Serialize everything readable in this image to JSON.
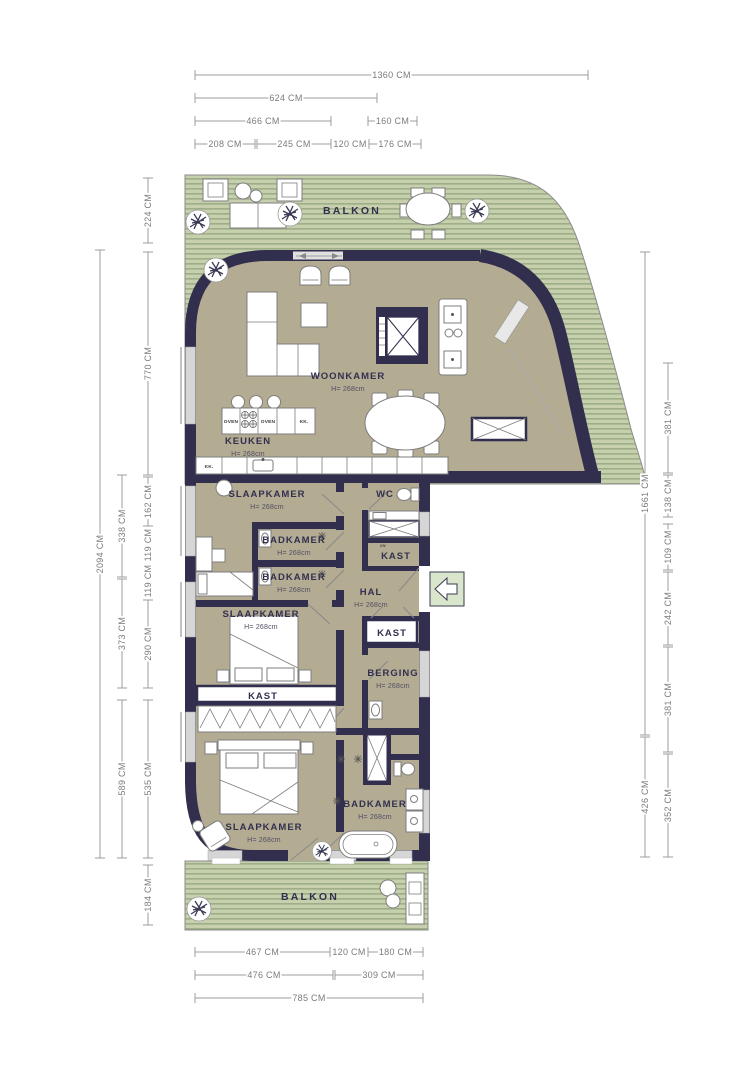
{
  "plan": {
    "title": "Apartment floor plan",
    "colors": {
      "wall": "#312e4e",
      "floor": "#b4ab93",
      "deck_base": "#c6d0ad",
      "deck_stripe": "#9aab85",
      "dimension_line": "#9c9c9c",
      "dimension_text": "#7b7b7b",
      "label_text": "#32304f",
      "entry_arrow_bg": "#d9e6cc"
    },
    "entry": {
      "icon": "arrow-left",
      "meaning": "entrance"
    },
    "rooms": [
      {
        "id": "balkon-top",
        "label": "BALKON",
        "x": 352,
        "y": 214
      },
      {
        "id": "woonkamer",
        "label": "WOONKAMER",
        "sub": "H= 268cm",
        "x": 348,
        "y": 379
      },
      {
        "id": "keuken",
        "label": "KEUKEN",
        "sub": "H= 268cm",
        "x": 248,
        "y": 444
      },
      {
        "id": "slaapkamer-1",
        "label": "SLAAPKAMER",
        "sub": "H= 268cm",
        "x": 267,
        "y": 497
      },
      {
        "id": "badkamer-1",
        "label": "BADKAMER",
        "sub": "H= 268cm",
        "x": 294,
        "y": 543
      },
      {
        "id": "badkamer-2",
        "label": "BADKAMER",
        "sub": "H= 268cm",
        "x": 294,
        "y": 580
      },
      {
        "id": "slaapkamer-2",
        "label": "SLAAPKAMER",
        "sub": "H= 268cm",
        "x": 261,
        "y": 617
      },
      {
        "id": "wc",
        "label": "WC",
        "x": 385,
        "y": 497
      },
      {
        "id": "kast-cv",
        "label": "KAST",
        "x": 396,
        "y": 559
      },
      {
        "id": "hal",
        "label": "HAL",
        "sub": "H= 268cm",
        "x": 371,
        "y": 595
      },
      {
        "id": "kast-hal",
        "label": "KAST",
        "x": 392,
        "y": 636
      },
      {
        "id": "berging",
        "label": "BERGING",
        "sub": "H= 268cm",
        "x": 393,
        "y": 676
      },
      {
        "id": "kast-slaapkamer",
        "label": "KAST",
        "x": 263,
        "y": 699
      },
      {
        "id": "slaapkamer-3",
        "label": "SLAAPKAMER",
        "sub": "H= 268cm",
        "x": 264,
        "y": 830
      },
      {
        "id": "badkamer-3",
        "label": "BADKAMER",
        "sub": "H= 268cm",
        "x": 375,
        "y": 807
      },
      {
        "id": "balkon-bottom",
        "label": "BALKON",
        "x": 310,
        "y": 900
      }
    ],
    "fixtures": [
      {
        "id": "oven-left",
        "label": "OVEN",
        "x": 231,
        "y": 423
      },
      {
        "id": "oven-right",
        "label": "OVEN",
        "x": 268,
        "y": 423
      },
      {
        "id": "kk-island",
        "label": "KK.",
        "x": 304,
        "y": 423
      },
      {
        "id": "kk-counter",
        "label": "KK.",
        "x": 209,
        "y": 468
      },
      {
        "id": "cv",
        "label": "cv",
        "x": 383,
        "y": 547
      }
    ],
    "dimensions": {
      "top": [
        {
          "label": "1360 CM",
          "x1": 195,
          "x2": 588,
          "y": 75
        },
        {
          "label": "624 CM",
          "x1": 195,
          "x2": 377,
          "y": 98
        },
        {
          "label": "466 CM",
          "x1": 195,
          "x2": 331,
          "y": 121
        },
        {
          "label": "160 CM",
          "x1": 368,
          "x2": 417,
          "y": 121
        },
        {
          "label": "208 CM",
          "x1": 195,
          "x2": 255,
          "y": 144
        },
        {
          "label": "245 CM",
          "x1": 257,
          "x2": 331,
          "y": 144
        },
        {
          "label": "120 CM",
          "x1": 333,
          "x2": 367,
          "y": 144
        },
        {
          "label": "176 CM",
          "x1": 369,
          "x2": 421,
          "y": 144
        }
      ],
      "bottom": [
        {
          "label": "467 CM",
          "x1": 195,
          "x2": 330,
          "y": 952
        },
        {
          "label": "120 CM",
          "x1": 333,
          "x2": 365,
          "y": 952
        },
        {
          "label": "180 CM",
          "x1": 368,
          "x2": 423,
          "y": 952
        },
        {
          "label": "476 CM",
          "x1": 195,
          "x2": 333,
          "y": 975
        },
        {
          "label": "309 CM",
          "x1": 335,
          "x2": 423,
          "y": 975
        },
        {
          "label": "785 CM",
          "x1": 195,
          "x2": 423,
          "y": 998
        }
      ],
      "left": [
        {
          "label": "224 CM",
          "x": 148,
          "y1": 178,
          "y2": 243
        },
        {
          "label": "770 CM",
          "x": 148,
          "y1": 252,
          "y2": 475
        },
        {
          "label": "162 CM",
          "x": 148,
          "y1": 477,
          "y2": 526
        },
        {
          "label": "119 CM",
          "x": 148,
          "y1": 528,
          "y2": 562
        },
        {
          "label": "119 CM",
          "x": 148,
          "y1": 564,
          "y2": 598
        },
        {
          "label": "290 CM",
          "x": 148,
          "y1": 600,
          "y2": 688
        },
        {
          "label": "535 CM",
          "x": 148,
          "y1": 700,
          "y2": 858
        },
        {
          "label": "184 CM",
          "x": 148,
          "y1": 865,
          "y2": 925
        },
        {
          "label": "338 CM",
          "x": 122,
          "y1": 475,
          "y2": 577
        },
        {
          "label": "373 CM",
          "x": 122,
          "y1": 579,
          "y2": 688
        },
        {
          "label": "589 CM",
          "x": 122,
          "y1": 700,
          "y2": 858
        },
        {
          "label": "2094 CM",
          "x": 100,
          "y1": 250,
          "y2": 858
        }
      ],
      "right": [
        {
          "label": "1661 CM",
          "x": 645,
          "y1": 252,
          "y2": 735
        },
        {
          "label": "426 CM",
          "x": 645,
          "y1": 737,
          "y2": 857
        },
        {
          "label": "381 CM",
          "x": 668,
          "y1": 363,
          "y2": 473
        },
        {
          "label": "138 CM",
          "x": 668,
          "y1": 475,
          "y2": 517
        },
        {
          "label": "109 CM",
          "x": 668,
          "y1": 524,
          "y2": 570
        },
        {
          "label": "242 CM",
          "x": 668,
          "y1": 572,
          "y2": 645
        },
        {
          "label": "381 CM",
          "x": 668,
          "y1": 647,
          "y2": 752
        },
        {
          "label": "352 CM",
          "x": 668,
          "y1": 754,
          "y2": 857
        }
      ]
    }
  }
}
